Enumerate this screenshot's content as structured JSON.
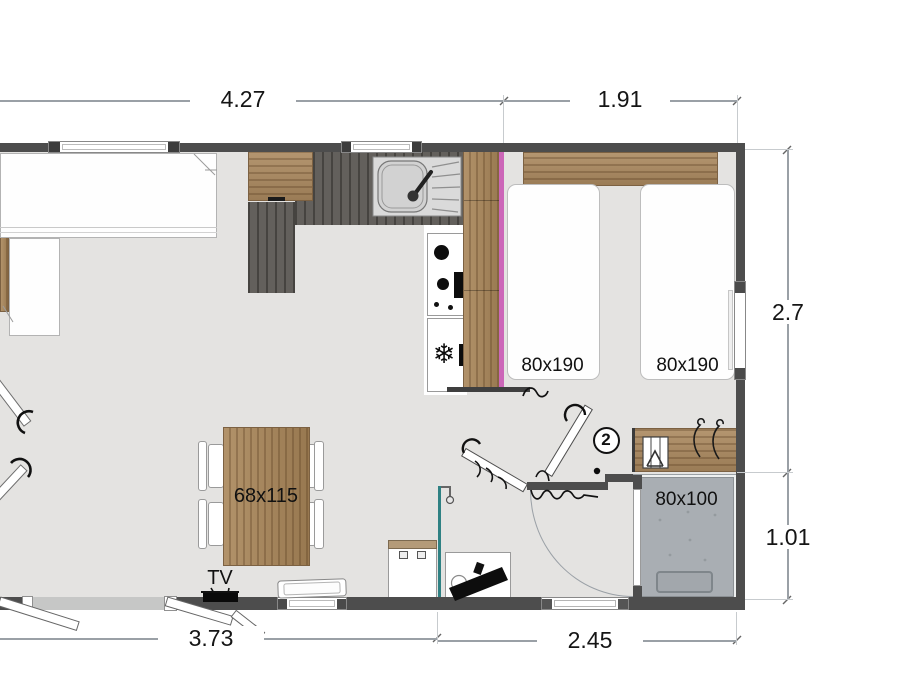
{
  "plan_title": "mobile-home-floor-plan",
  "dimensions": {
    "top_left": "4.27",
    "top_right": "1.91",
    "right_upper": "2.7",
    "right_lower": "1.01",
    "bottom_left": "3.73",
    "bottom_right": "2.45"
  },
  "labels": {
    "bed_left": "80x190",
    "bed_right": "80x190",
    "dining_table": "68x115",
    "shower": "80x100",
    "tv": "TV",
    "room_badge": "2"
  },
  "icons": {
    "snowflake": "❄"
  },
  "colors": {
    "wall": "#4d4d4d",
    "floor": "#e4e3e1",
    "wood": "#ac8a60",
    "counter_dark": "#5d5a55",
    "partition_magenta": "#cc66b8",
    "partition_teal": "#2f8183",
    "shower_gray": "#a9aeb3",
    "dimension_line": "#9aa0a6"
  }
}
